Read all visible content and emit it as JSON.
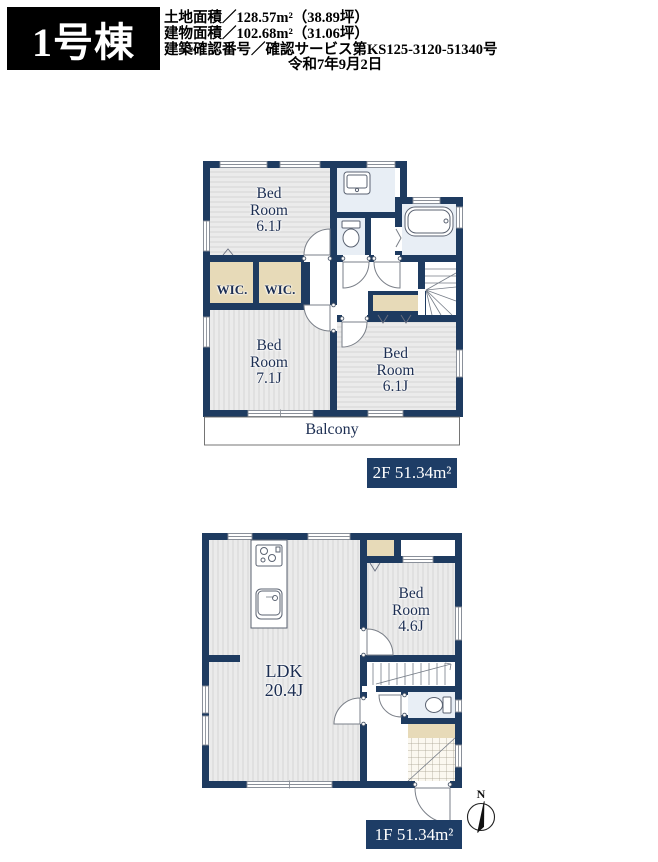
{
  "header": {
    "unit_name": "1号棟",
    "land_area": "土地面積／128.57m²（38.89坪）",
    "building_area": "建物面積／102.68m²（31.06坪）",
    "confirmation": "建築確認番号／確認サービス第KS125-3120-51340号",
    "confirmation_date": "令和7年9月2日"
  },
  "floor2": {
    "bedroom_nw": {
      "line1": "Bed",
      "line2": "Room",
      "line3": "6.1J"
    },
    "wic_left": "WIC.",
    "wic_right": "WIC.",
    "bedroom_sw": {
      "line1": "Bed",
      "line2": "Room",
      "line3": "7.1J"
    },
    "bedroom_se": {
      "line1": "Bed",
      "line2": "Room",
      "line3": "6.1J"
    },
    "balcony_label": "Balcony",
    "area_label": "2F 51.34m²"
  },
  "floor1": {
    "ldk": {
      "line1": "LDK",
      "line2": "20.4J"
    },
    "bedroom": {
      "line1": "Bed",
      "line2": "Room",
      "line3": "4.6J"
    },
    "area_label": "1F 51.34m²",
    "compass_label": "N"
  },
  "colors": {
    "wall_navy": "#1e3b60",
    "badge_navy": "#1e3d66",
    "wet_area_blue": "#e8eef5",
    "closet_beige": "#e7dab8",
    "room_gray": "#ebebeb",
    "room_stripe": "#d9d9d9",
    "label_text_navy": "#1c2e52"
  }
}
